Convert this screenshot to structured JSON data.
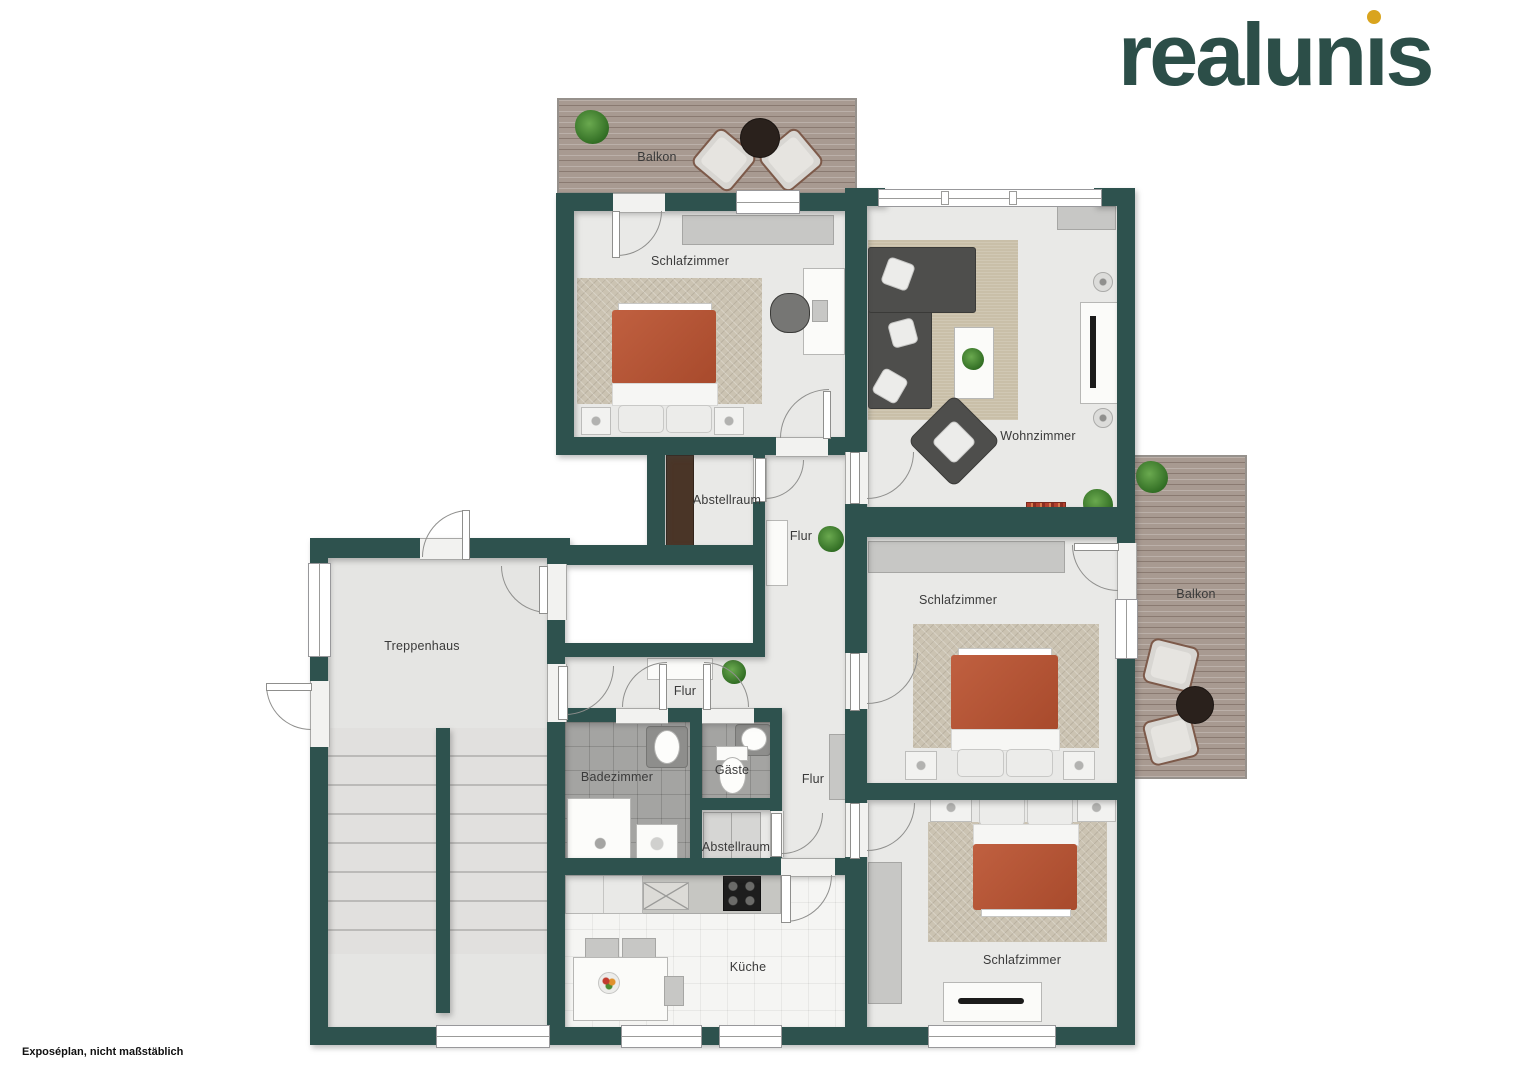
{
  "brand": {
    "logo_pre": "realun",
    "logo_i": "ı",
    "logo_post": "s",
    "logo_color": "#2c4e48",
    "logo_dot_color": "#d9a41e"
  },
  "footer": {
    "note": "Exposéplan, nicht maßstäblich"
  },
  "labels": {
    "balkon_top": "Balkon",
    "schlafzimmer_top": "Schlafzimmer",
    "wohnzimmer": "Wohnzimmer",
    "abstellraum_top": "Abstellraum",
    "flur_top": "Flur",
    "balkon_right": "Balkon",
    "schlafzimmer_mid": "Schlafzimmer",
    "treppenhaus": "Treppenhaus",
    "flur_mid": "Flur",
    "badezimmer": "Badezimmer",
    "gaeste": "Gäste",
    "flur_bottom": "Flur",
    "abstellraum_bottom": "Abstellraum",
    "kueche": "Küche",
    "schlafzimmer_bottom": "Schlafzimmer"
  },
  "colors": {
    "wall": "#2e524e",
    "bed_blanket": "#b45638",
    "wood_deck": "#a89a91",
    "room_floor": "#e9e9e7"
  }
}
